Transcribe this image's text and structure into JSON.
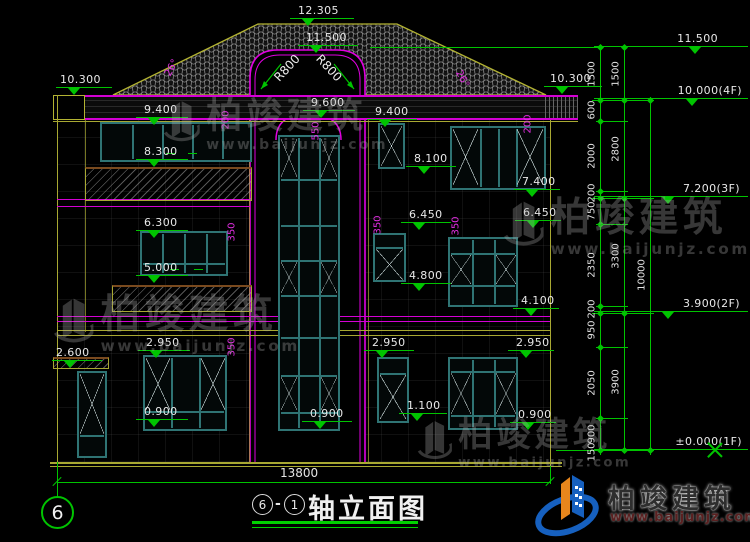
{
  "brand": {
    "name": "柏竣建筑",
    "url": "www.baijunjz.com"
  },
  "footer": {
    "axis_bubble": "6",
    "title_circle_a": "6",
    "title_dash": "-",
    "title_circle_b": "1",
    "title": "轴立面图",
    "overall_width_mm": "13800"
  },
  "elevations": {
    "ridge": "12.305",
    "arch_top": "11.500",
    "eave_left": "10.300",
    "eave_right": "10.300",
    "e9600": "9.600",
    "e9400_left": "9.400",
    "e9400_right": "9.400",
    "e8300": "8.300",
    "e8100": "8.100",
    "e7400": "7.400",
    "e6450_a": "6.450",
    "e6450_b": "6.450",
    "e6300": "6.300",
    "e5000": "5.000",
    "e4800": "4.800",
    "e4100": "4.100",
    "e2950_a": "2.950",
    "e2950_b": "2.950",
    "e2950_c": "2.950",
    "e2600": "2.600",
    "e1100": "1.100",
    "e0900_a": "0.900",
    "e0900_b": "0.900",
    "e0900_c": "0.900",
    "right_11500": "11.500",
    "right_10000": "10.000(4F)",
    "right_7200": "7.200(3F)",
    "right_3900": "3.900(2F)",
    "right_0000": "±0.000(1F)"
  },
  "dims": {
    "chain_outer": [
      "1500",
      "600",
      "2000",
      "200",
      "750",
      "2350",
      "200",
      "950",
      "2050",
      "900",
      "150"
    ],
    "chain_mid": [
      "1500",
      "2800",
      "3300",
      "3900"
    ],
    "chain_total": "10000",
    "d200_left": "200",
    "d200_right": "200",
    "d550": "550",
    "d350_left_top": "350",
    "d350_left_bottom": "350",
    "d350_mid": "350",
    "d350_right": "350",
    "angle_left": "26°",
    "angle_right": "26°",
    "r800_left": "R800",
    "r800_right": "R800"
  }
}
